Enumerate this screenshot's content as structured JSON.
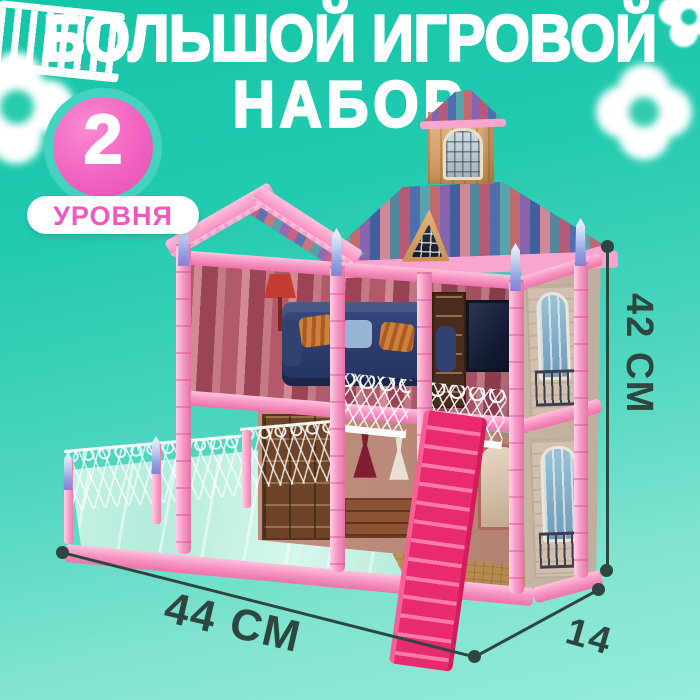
{
  "meta": {
    "kind": "product-marketing-image",
    "language": "ru",
    "subject": "toy dollhouse playset"
  },
  "background": {
    "top_color": "#14c5a7",
    "bottom_color": "#95ecda",
    "decor": "white four-petal flowers"
  },
  "title": {
    "line1": "БОЛЬШОЙ ИГРОВОЙ",
    "line2": "НАБОР",
    "color": "#ffffff"
  },
  "badge": {
    "number": "2",
    "label": "УРОВНЯ",
    "circle_color": "#f163c1",
    "ring_color": "#43d3bf",
    "pill_color": "#ffffff",
    "label_color": "#ef58bd"
  },
  "dimensions": {
    "height": "42 СМ",
    "width": "44 СМ",
    "depth": "14",
    "annotation_color": "#2d463f"
  },
  "product": {
    "palette": {
      "pink_light": "#ffc2de",
      "pink_frame": "#f590bf",
      "magenta_stairs": "#e82a6e",
      "finial_blue": "#93a2e2",
      "tower_wood": "#d4a26c",
      "side_wall_stone": "#cfc0b0",
      "sofa_navy": "#2c3e6e",
      "mirror_floor": "#b2ecdc",
      "parquet": "#c6985e",
      "roof_tile_colors": [
        "#ba5a74",
        "#506eae",
        "#56a8ac",
        "#c66a6a",
        "#8a64ae",
        "#3e5f9e",
        "#d68a9a",
        "#54889e"
      ]
    }
  }
}
